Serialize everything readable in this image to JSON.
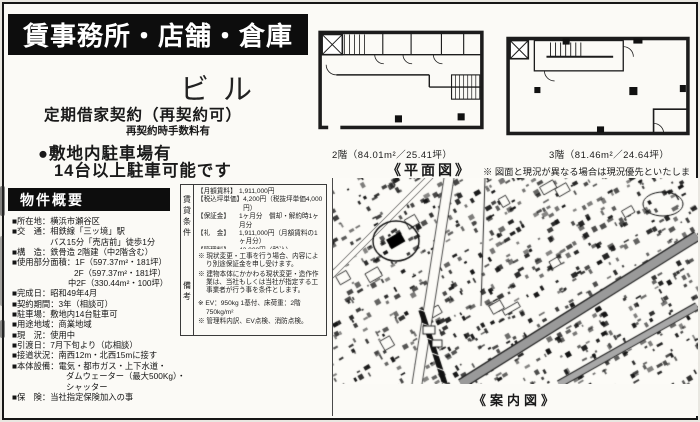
{
  "colors": {
    "banner_bg": "#0d0d0d",
    "paper": "#fbfaf6",
    "ink": "#1a1a1a"
  },
  "header": {
    "banner_title": "賃事務所・店舗・倉庫",
    "building_name": "ビル",
    "contract_type": "定期借家契約（再契約可）",
    "contract_note": "再契約時手数料有",
    "parking_line1": "●敷地内駐車場有",
    "parking_line2": "14台以上駐車可能です"
  },
  "overview": {
    "title": "物件概要",
    "lines": [
      "■所在地：横浜市瀬谷区",
      "■交　通：相鉄線「三ッ境」駅",
      "バス15分「売店前」徒歩1分",
      "■構　造：鉄骨造 2階建（中2階含む）",
      "■使用部分面積：1F（597.37m²・181坪）",
      "2F（597.37m²・181坪）",
      "中2F（330.44m²・100坪）",
      "■完成日：昭和49年4月",
      "■契約期間：3年（相談可）",
      "■駐車場：敷地内14台駐車可",
      "■用途地域：商業地域",
      "■現　況：使用中",
      "■引渡日：7月下旬より（応相談）",
      "■接道状況：南西12m・北西15mに接す",
      "■本体設備：電気・都市ガス・上下水道・",
      "ダムウェーター（最大500Kg）・",
      "シャッター",
      "■保　険：当社指定保険加入の事"
    ]
  },
  "conditions": {
    "side_label": "賃貸条件",
    "rows": [
      {
        "label": "【月額賃料】",
        "value": "1,911,000円"
      },
      {
        "label": "【税込坪単価】",
        "value": "4,200円（税抜坪単価4,000円）"
      },
      {
        "label": "【保証金】",
        "value": "1ヶ月分　償却・解約時1ヶ月分"
      },
      {
        "label": "【礼　金】",
        "value": "1,911,000円（月額賃料の1ヶ月分）"
      },
      {
        "label": "【管理料】",
        "value": "42,000円（税込）"
      },
      {
        "label": "【支払条件】",
        "value": "前月末日締め、翌月末日払い、振り込み"
      },
      {
        "label": "【その他】",
        "value": ""
      }
    ]
  },
  "remarks": {
    "side_label": "備考",
    "notes": [
      "※ 現状変更・工事を行う場合、内容により別途保証金を申し受けます。",
      "※ 建物本体にかかわる現状変更・造作作業は、当社もしくは当社が指定する工事業者が行う事を条件とします。",
      "※ EV：950kg 1基付、床荷重：2階 750kg/m²",
      "※ 管理料内訳、EV点検、消防点検。"
    ]
  },
  "floorplans": {
    "plan2_caption": "2階（84.01m²／25.41坪）",
    "plan3_caption": "3階（81.46m²／24.64坪）",
    "section_label": "《平面図》",
    "disclaimer": "※ 図面と現況が異なる場合は現況優先といたします。"
  },
  "map": {
    "caption": "《案内図》"
  }
}
